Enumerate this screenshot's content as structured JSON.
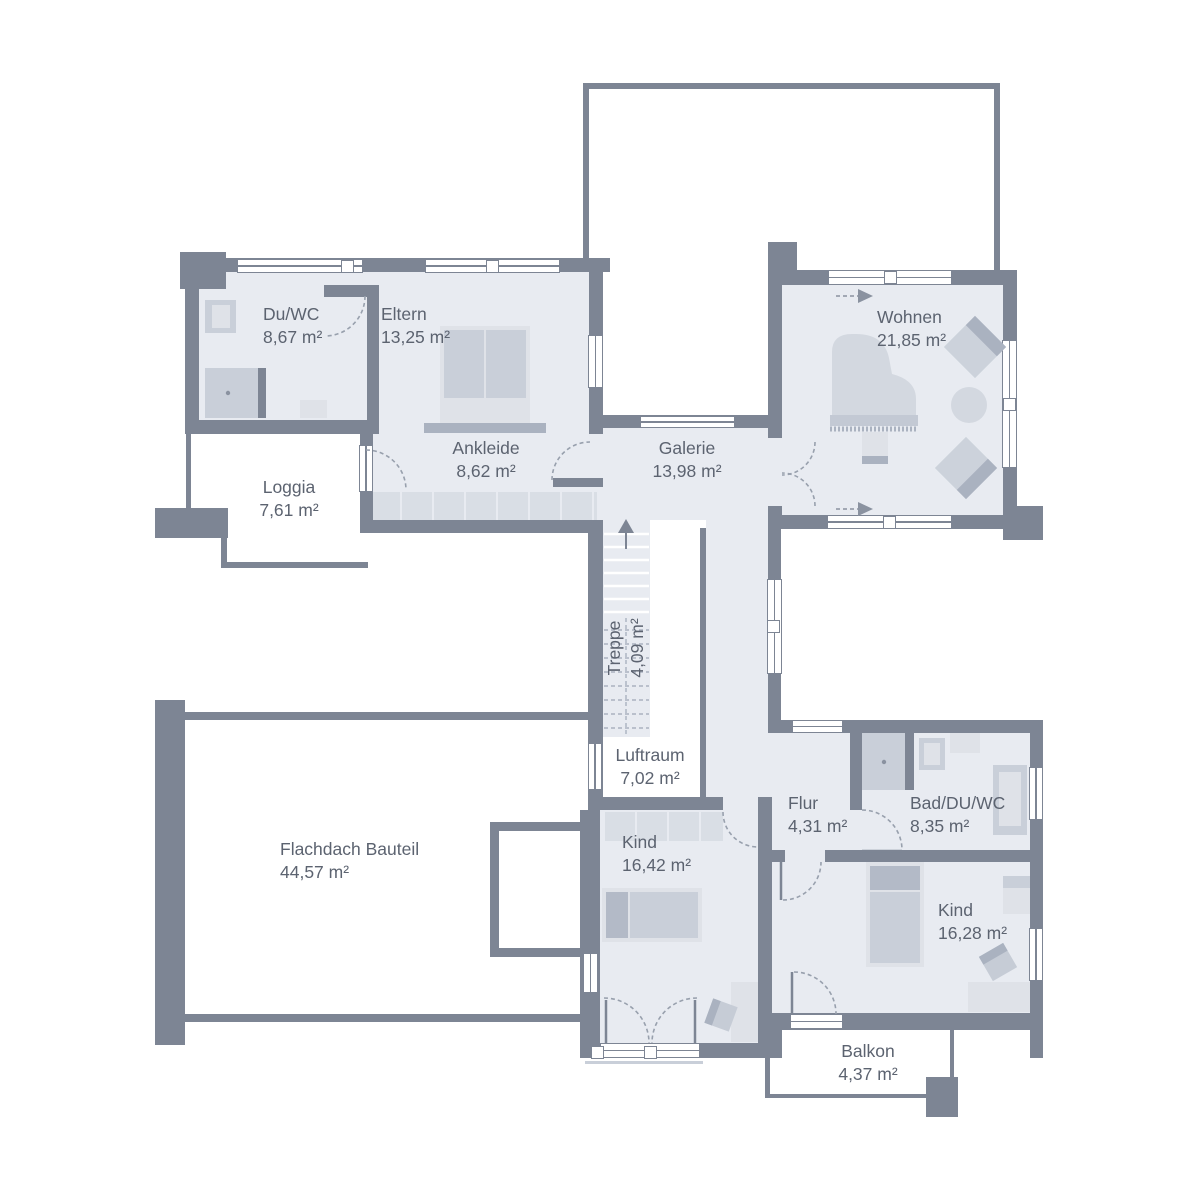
{
  "rooms": {
    "du_wc": {
      "name": "Du/WC",
      "area": "8,67 m²"
    },
    "eltern": {
      "name": "Eltern",
      "area": "13,25 m²"
    },
    "ankleide": {
      "name": "Ankleide",
      "area": "8,62 m²"
    },
    "loggia": {
      "name": "Loggia",
      "area": "7,61 m²"
    },
    "galerie": {
      "name": "Galerie",
      "area": "13,98 m²"
    },
    "wohnen": {
      "name": "Wohnen",
      "area": "21,85 m²"
    },
    "treppe": {
      "name": "Treppe",
      "area": "4,09 m²"
    },
    "luftraum": {
      "name": "Luftraum",
      "area": "7,02 m²"
    },
    "flachdach": {
      "name": "Flachdach Bauteil",
      "area": "44,57 m²"
    },
    "kind1": {
      "name": "Kind",
      "area": "16,42 m²"
    },
    "flur": {
      "name": "Flur",
      "area": "4,31 m²"
    },
    "bad": {
      "name": "Bad/DU/WC",
      "area": "8,35 m²"
    },
    "kind2": {
      "name": "Kind",
      "area": "16,28 m²"
    },
    "balkon": {
      "name": "Balkon",
      "area": "4,37 m²"
    }
  },
  "colors": {
    "wall": "#7d8594",
    "floor": "#e8ebf1",
    "furniture_light": "#dfe2e8",
    "furniture_mid": "#c9cfd9",
    "furniture_dark": "#aab2c0",
    "text": "#5c6370"
  }
}
